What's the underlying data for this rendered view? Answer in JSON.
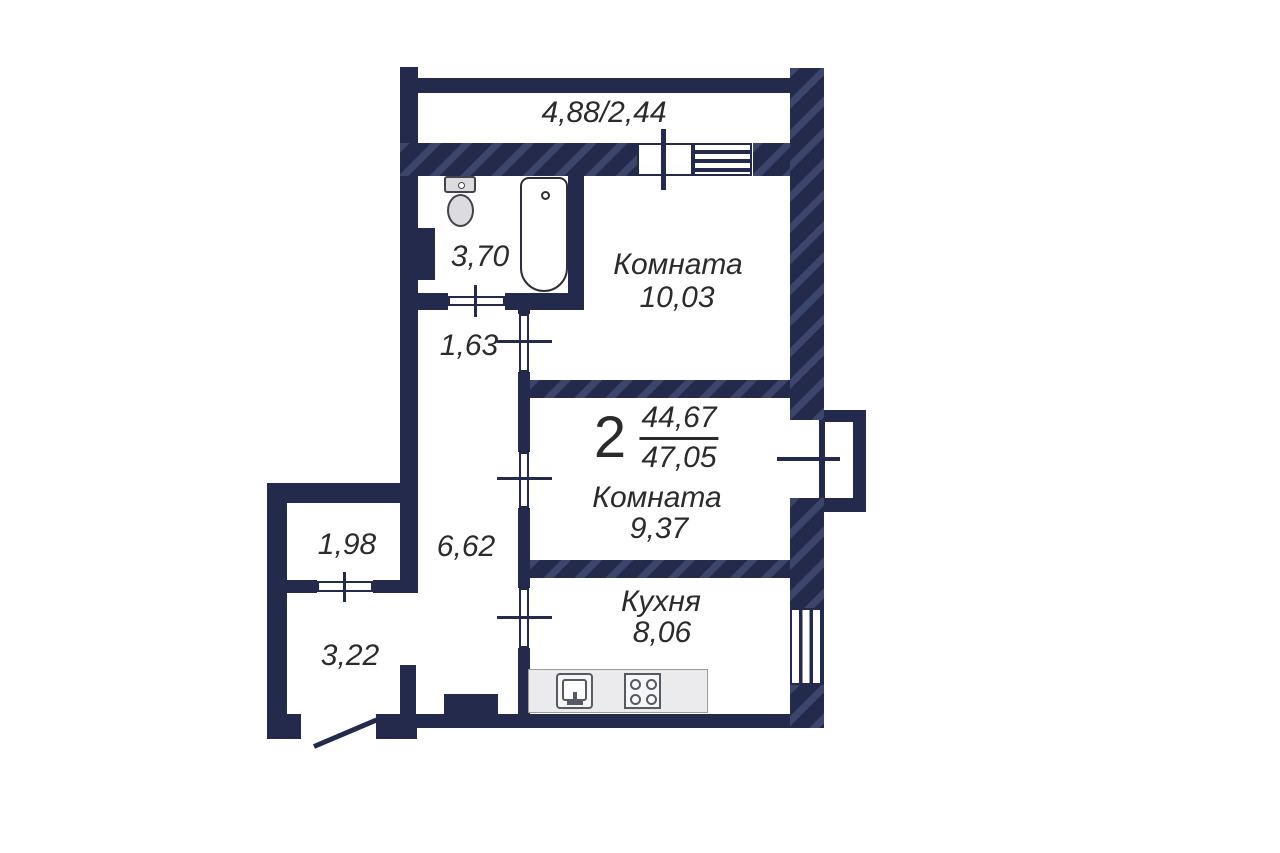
{
  "apartment": {
    "rooms_count": "2",
    "living_area": "44,67",
    "total_area": "47,05"
  },
  "balcony": {
    "area_label": "4,88/2,44"
  },
  "rooms": {
    "bathroom": {
      "area": "3,70"
    },
    "hall_upper": {
      "area": "1,63"
    },
    "room_upper": {
      "name": "Комната",
      "area": "10,03"
    },
    "room_middle": {
      "name": "Комната",
      "area": "9,37"
    },
    "corridor": {
      "area": "6,62"
    },
    "kitchen": {
      "name": "Кухня",
      "area": "8,06"
    },
    "storage": {
      "area": "1,98"
    },
    "entry_hall": {
      "area": "3,22"
    }
  },
  "colors": {
    "wall": "#232a4c",
    "wall_hatch_stripe": "#39426e",
    "floor": "#ffffff",
    "text": "#2b2b2b",
    "fixture_outline": "#43434b",
    "fixture_fill": "#dcdcdf",
    "counter_fill": "#ebebed"
  }
}
